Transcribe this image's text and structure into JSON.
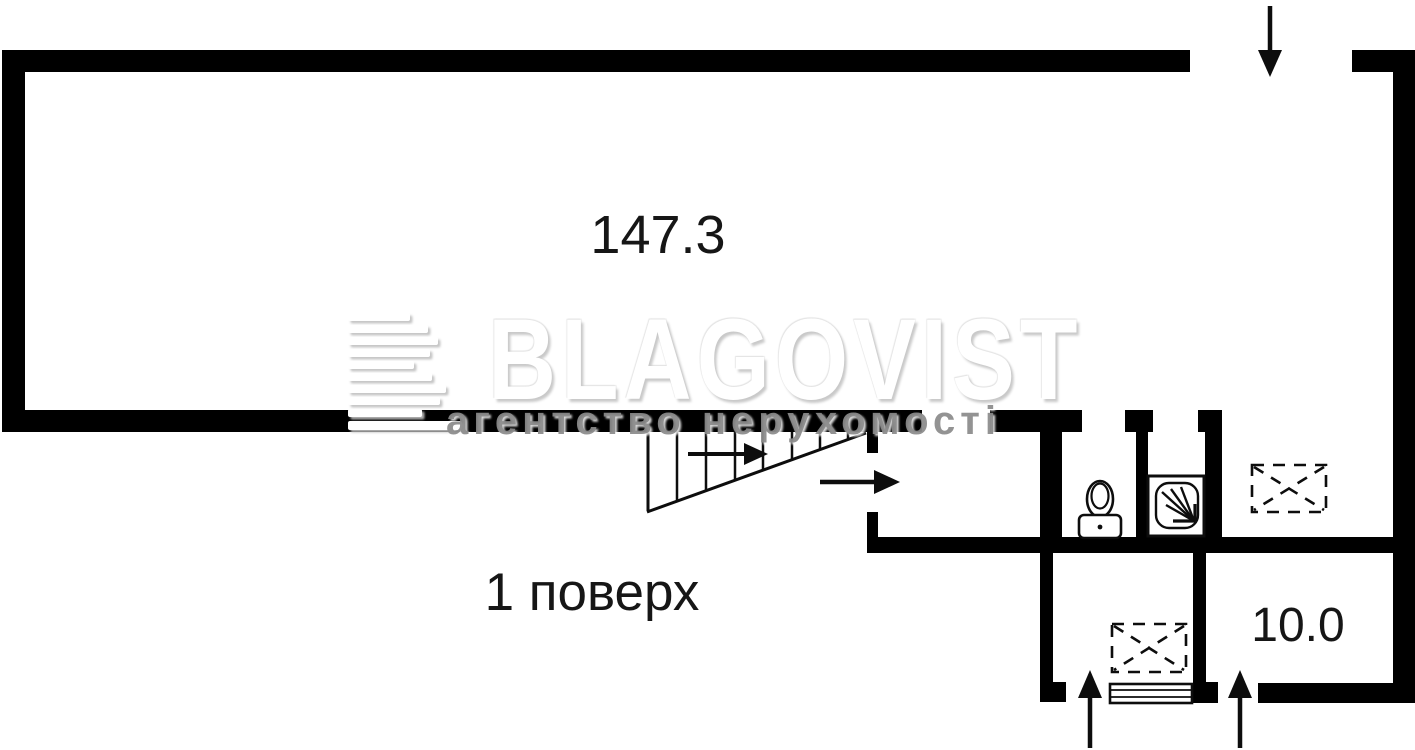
{
  "plan": {
    "floor_label": "1 поверх",
    "rooms": [
      {
        "id": "main-hall",
        "area_label": "147.3"
      },
      {
        "id": "lower-right-room",
        "area_label": "10.0"
      }
    ],
    "watermark": {
      "brand": "BLAGOVIST",
      "tagline": "агентство нерухомості",
      "logo_icon": "striped-b-logo"
    },
    "icons": {
      "stairs": "stairs-run-icon",
      "stairs_direction": "stairs-direction-arrow-icon",
      "top_entrance": "entrance-down-arrow-icon",
      "corridor_direction": "corridor-right-arrow-icon",
      "lower_left_entrance": "entrance-up-arrow-icon",
      "lower_right_entrance": "entrance-up-arrow-icon",
      "toilet": "toilet-icon",
      "shower": "shower-icon",
      "blocked_opening_upper": "blocked-opening-x-icon",
      "blocked_opening_lower": "blocked-opening-x-icon",
      "window": "window-sill-icon"
    },
    "colors": {
      "wall": "#000000",
      "line": "#0d0d0d",
      "background": "#ffffff",
      "watermark_gray": "#8a8a8a",
      "watermark_white": "#ffffff"
    }
  }
}
